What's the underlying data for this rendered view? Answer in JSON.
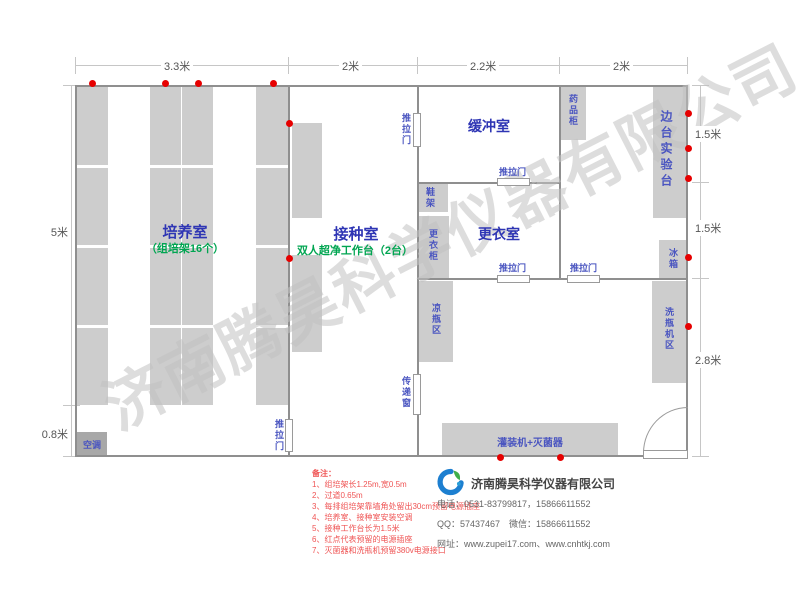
{
  "watermark": "济南腾昊科学仪器有限公司",
  "dims": {
    "top": [
      "3.3米",
      "2米",
      "2.2米",
      "2米"
    ],
    "left": [
      "5米",
      "0.8米"
    ],
    "right": [
      "1.5米",
      "1.5米",
      "2.8米"
    ]
  },
  "rooms": {
    "culture": {
      "name": "培养室",
      "note": "（组培架16个）"
    },
    "inoculation": {
      "name": "接种室",
      "note": "双人超净工作台（2台）"
    },
    "buffer": {
      "name": "缓冲室"
    },
    "dressing": {
      "name": "更衣室"
    },
    "side_bench": {
      "name": "边台实验台"
    }
  },
  "labels": {
    "sliding_door": "推拉门",
    "pass_window": "传递窗",
    "shoe_rack": "鞋架",
    "wardrobe": "更衣柜",
    "medicine_cabinet": "药品柜",
    "fridge": "冰箱",
    "cool_bottle_area": "凉瓶区",
    "bottle_washer_area": "洗瓶机区",
    "filling_sterilizer": "灌装机+灭菌器",
    "air_conditioner": "空调"
  },
  "notes": {
    "title": "备注：",
    "items": [
      "1、组培架长1.25m,宽0.5m",
      "2、过道0.65m",
      "3、每排组培架靠墙角处留出30cm预留电源插座",
      "4、培养室、接种室安装空调",
      "5、接种工作台长为1.5米",
      "6、红点代表预留的电源插座",
      "7、灭菌器和洗瓶机预留380v电源接口"
    ]
  },
  "company": {
    "name": "济南腾昊科学仪器有限公司",
    "phone": "电话：0531-83799817，15866611552",
    "qq": "QQ：57437467　微信：15866611552",
    "web": "网址：www.zupei17.com、www.cnhtkj.com"
  },
  "colors": {
    "wall": "#8f8f8f",
    "furniture": "#cdcdcd",
    "room_label_blue": "#2e35b4",
    "small_label_blue": "#4a55c0",
    "green_note": "#00a551",
    "power_dot_red": "#e60000",
    "note_red": "#ef5454"
  }
}
